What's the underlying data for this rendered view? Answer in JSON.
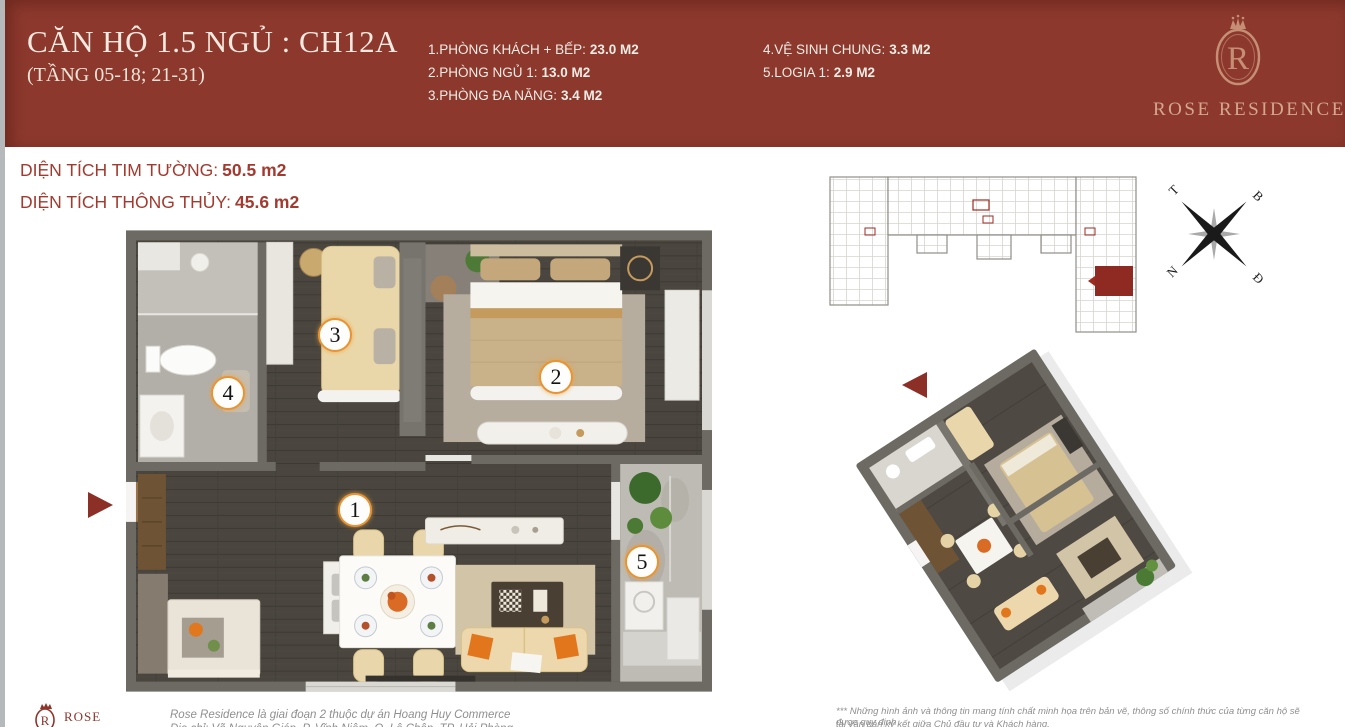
{
  "header": {
    "title": "CĂN HỘ 1.5 NGỦ : CH12A",
    "subtitle": "(TẦNG 05-18; 21-31)",
    "specs_col1": [
      {
        "label": "1.PHÒNG KHÁCH + BẾP:",
        "value": "23.0 M2"
      },
      {
        "label": "2.PHÒNG NGỦ 1:",
        "value": "13.0 M2"
      },
      {
        "label": "3.PHÒNG ĐA NĂNG:",
        "value": "3.4 M2"
      }
    ],
    "specs_col2": [
      {
        "label": "4.VỆ SINH CHUNG:",
        "value": "3.3 M2"
      },
      {
        "label": "5.LOGIA 1:",
        "value": "2.9 M2"
      }
    ],
    "brand_name": "ROSE RESIDENCE",
    "monogram": "R"
  },
  "areas": [
    {
      "label": "DIỆN TÍCH TIM TƯỜNG:",
      "value": "50.5 m2"
    },
    {
      "label": "DIỆN TÍCH THÔNG THỦY:",
      "value": "45.6 m2"
    }
  ],
  "floor_plan": {
    "badges": [
      "1",
      "2",
      "3",
      "4",
      "5"
    ]
  },
  "compass": {
    "west": "T",
    "north": "B",
    "south": "N",
    "east": "Đ"
  },
  "footer": {
    "brand_name": "ROSE",
    "monogram": "R",
    "note_line1": "Rose Residence là giai đoạn 2 thuộc dự án Hoang Huy Commerce",
    "note_line2": "Địa chỉ: Võ Nguyên Giáp, P. Vĩnh Niệm, Q. Lê Chân, TP. Hải Phòng",
    "disclaimer_line1": "*** Những hình ảnh và thông tin mang tính chất minh họa trên bản vẽ, thông số chính thức của từng căn hộ sẽ được quy định",
    "disclaimer_line2": "tại văn bản ký kết giữa Chủ đầu tư và Khách hàng."
  },
  "colors": {
    "header_bg": "#8c382d",
    "header_text": "#f2ece5",
    "logo_gold": "#c68f75",
    "logo_text": "#d5a78d",
    "body_red": "#a23a2f",
    "badge_border": "#e89433",
    "arrow_red": "#8c2f26",
    "wall_gray": "#6c6a63",
    "wood_floor": "#4a463f",
    "highlight_unit_red": "#8e2a22"
  }
}
